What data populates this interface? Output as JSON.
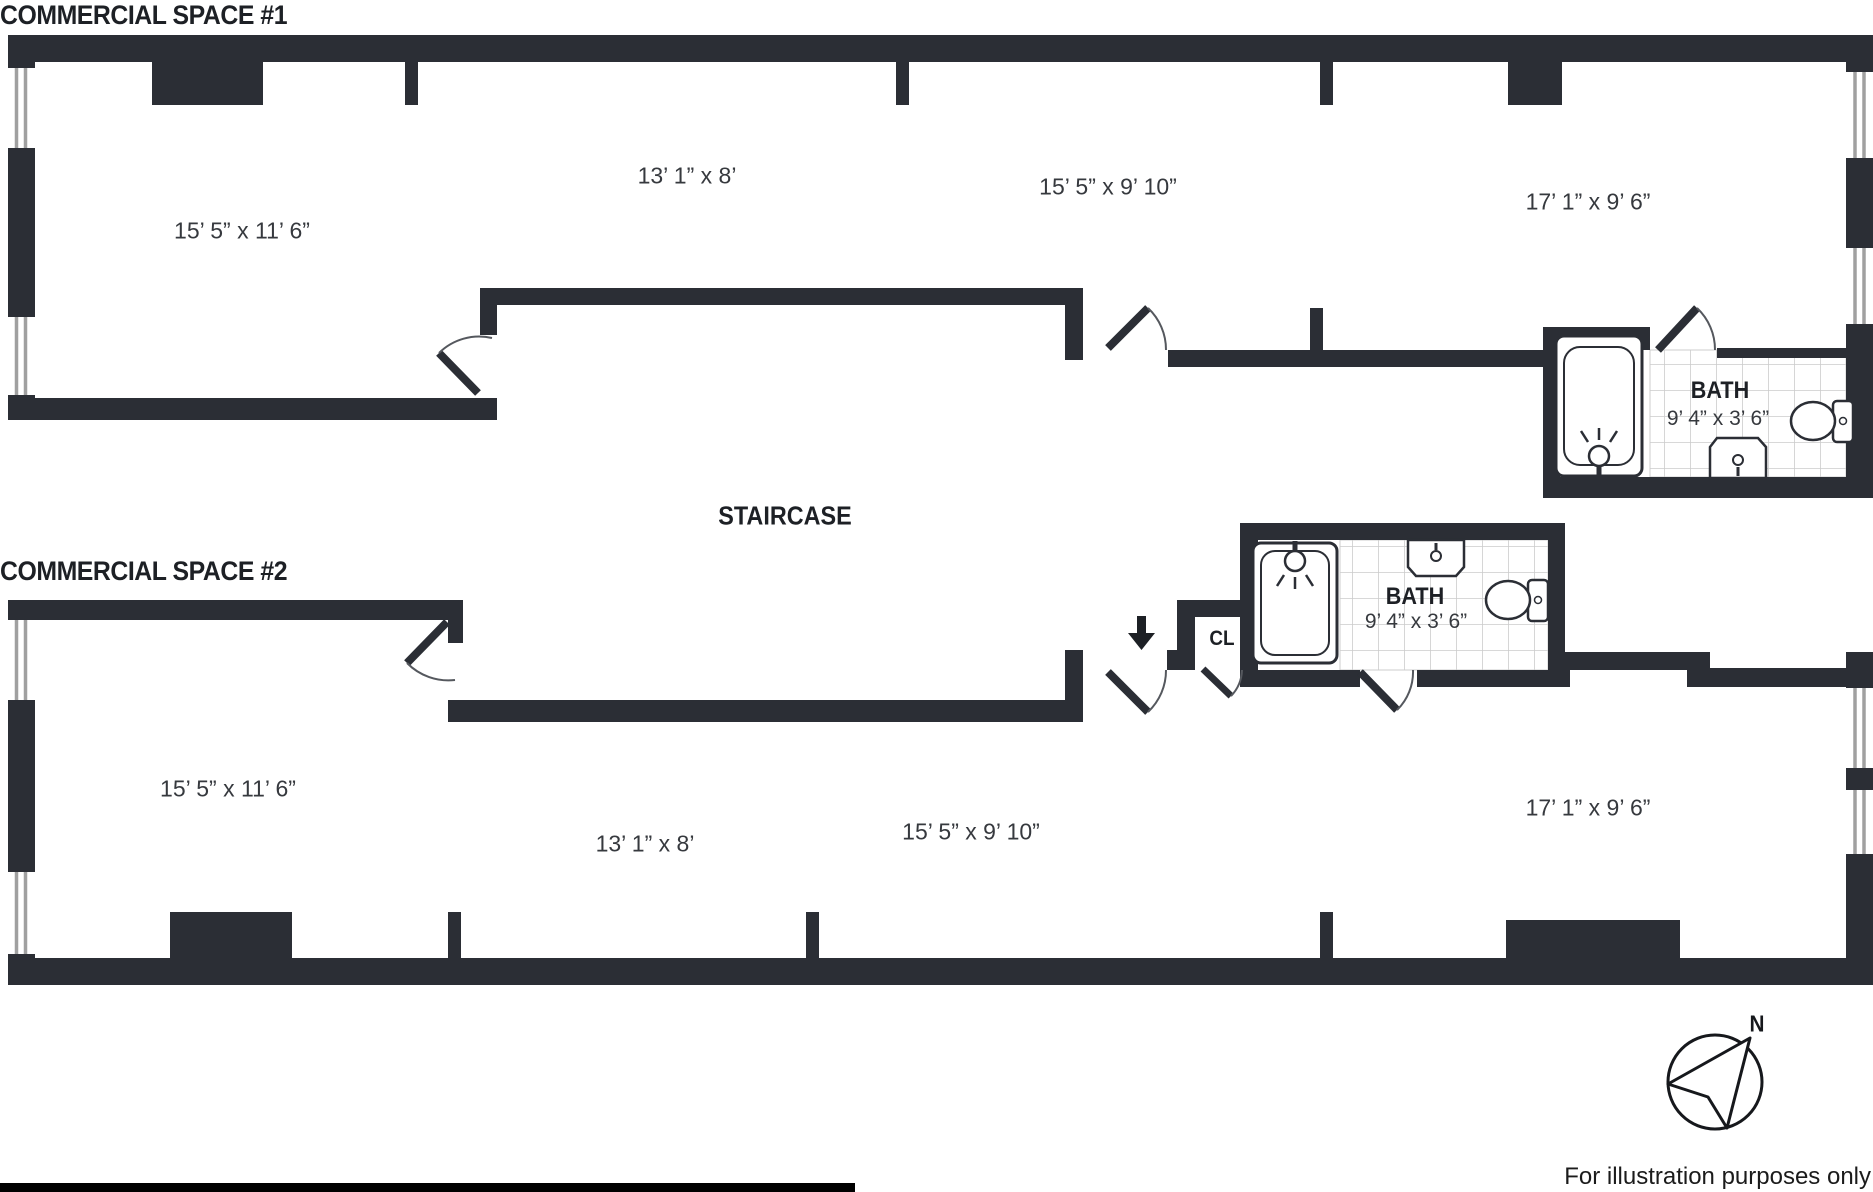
{
  "titles": {
    "space1": "COMMERCIAL SPACE #1",
    "space2": "COMMERCIAL SPACE #2"
  },
  "staircase": {
    "label": "STAIRCASE"
  },
  "space1": {
    "rooms": [
      {
        "dims": "15’ 5” x 11’ 6”"
      },
      {
        "dims": "13’ 1” x 8’"
      },
      {
        "dims": "15’ 5” x 9’ 10”"
      },
      {
        "dims": "17’ 1” x 9’ 6”"
      }
    ],
    "bath": {
      "label": "BATH",
      "dims": "9’ 4” x 3’ 6”"
    }
  },
  "space2": {
    "rooms": [
      {
        "dims": "15’ 5” x 11’ 6”"
      },
      {
        "dims": "13’ 1” x 8’"
      },
      {
        "dims": "15’ 5” x 9’ 10”"
      },
      {
        "dims": "17’ 1” x 9’ 6”"
      }
    ],
    "bath": {
      "label": "BATH",
      "dims": "9’ 4” x 3’ 6”"
    },
    "closet": {
      "label": "CL"
    }
  },
  "compass": {
    "north": "N"
  },
  "footer": {
    "note": "For illustration purposes only"
  },
  "colors": {
    "wall": "#2b2e35",
    "title_text": "#1d2025",
    "dimension_text": "#36393e",
    "tile_line": "#cccccc",
    "window_stripe": "#a0a0a0",
    "background": "#ffffff",
    "bottom_bar": "#000000"
  }
}
